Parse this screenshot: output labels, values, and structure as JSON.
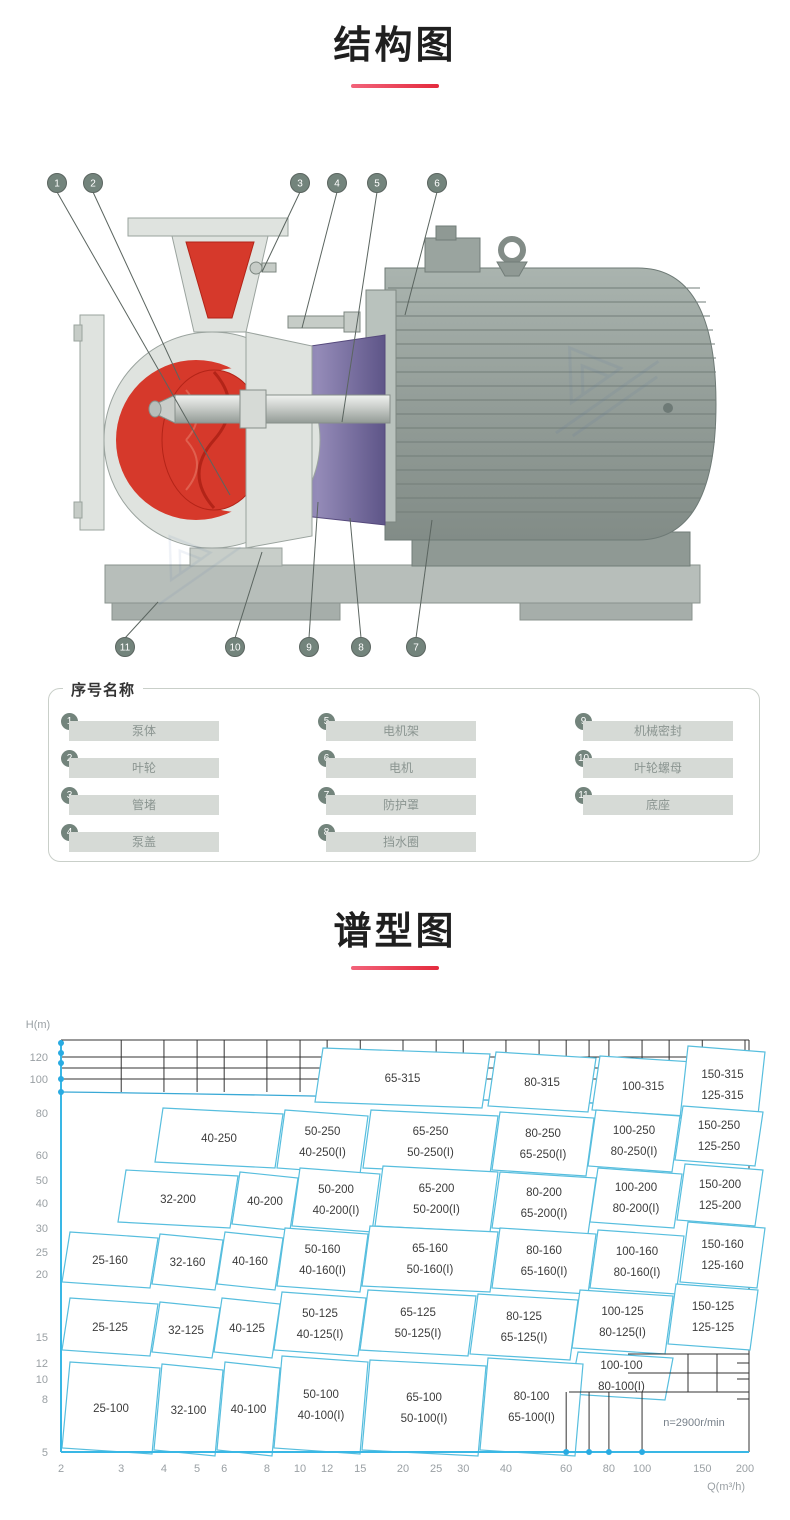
{
  "accent_color": "#e42a3d",
  "sections": {
    "structure": {
      "title": "结构图"
    },
    "spectrum": {
      "title": "谱型图"
    }
  },
  "legend": {
    "title": "序号名称",
    "items": [
      {
        "no": "1",
        "name": "泵体"
      },
      {
        "no": "2",
        "name": "叶轮"
      },
      {
        "no": "3",
        "name": "管堵"
      },
      {
        "no": "4",
        "name": "泵盖"
      },
      {
        "no": "5",
        "name": "电机架"
      },
      {
        "no": "6",
        "name": "电机"
      },
      {
        "no": "7",
        "name": "防护罩"
      },
      {
        "no": "8",
        "name": "挡水圈"
      },
      {
        "no": "9",
        "name": "机械密封"
      },
      {
        "no": "10",
        "name": "叶轮螺母"
      },
      {
        "no": "11",
        "name": "底座"
      }
    ]
  },
  "diagram": {
    "callouts_top": [
      "1",
      "2",
      "3",
      "4",
      "5",
      "6"
    ],
    "callouts_bottom": [
      "11",
      "10",
      "9",
      "8",
      "7"
    ],
    "colors": {
      "casing": "#dfe3df",
      "impeller_red": "#d6392b",
      "bracket_purple": "#837aab",
      "motor_gray": "#99a39e",
      "base_gray": "#b7beba",
      "callout": "#73847c"
    }
  },
  "chart_data": {
    "type": "area",
    "subtype": "pump-selection-map",
    "title": "谱型图",
    "xlabel": "Q(m³/h)",
    "ylabel": "H(m)",
    "x_scale": "log",
    "x_range": [
      2,
      200
    ],
    "y_range": [
      5,
      150
    ],
    "x_ticks": [
      2,
      3,
      4,
      5,
      6,
      8,
      10,
      12,
      15,
      20,
      25,
      30,
      40,
      60,
      80,
      100,
      150,
      200
    ],
    "y_ticks": [
      120,
      100,
      80,
      60,
      50,
      40,
      30,
      25,
      20,
      15,
      12,
      10,
      8,
      5
    ],
    "annotation": "n=2900r/min",
    "legend_position": "bottom-right",
    "grid": true,
    "tiles": [
      {
        "labels": [
          "65-315"
        ],
        "box": [
          315,
          38,
          482,
          92
        ]
      },
      {
        "labels": [
          "80-315"
        ],
        "box": [
          488,
          42,
          588,
          96
        ]
      },
      {
        "labels": [
          "100-315"
        ],
        "box": [
          592,
          46,
          686,
          100
        ]
      },
      {
        "labels": [
          "150-315",
          "125-315"
        ],
        "box": [
          680,
          36,
          757,
          108
        ]
      },
      {
        "labels": [
          "40-250"
        ],
        "box": [
          155,
          98,
          275,
          152
        ]
      },
      {
        "labels": [
          "50-250",
          "40-250(I)"
        ],
        "box": [
          277,
          100,
          360,
          158
        ]
      },
      {
        "labels": [
          "65-250",
          "50-250(I)"
        ],
        "box": [
          363,
          100,
          490,
          158
        ]
      },
      {
        "labels": [
          "80-250",
          "65-250(I)"
        ],
        "box": [
          492,
          102,
          586,
          160
        ]
      },
      {
        "labels": [
          "100-250",
          "80-250(I)"
        ],
        "box": [
          588,
          100,
          672,
          156
        ]
      },
      {
        "labels": [
          "150-250",
          "125-250"
        ],
        "box": [
          675,
          96,
          755,
          150
        ]
      },
      {
        "labels": [
          "32-200"
        ],
        "box": [
          118,
          160,
          230,
          212
        ]
      },
      {
        "labels": [
          "40-200"
        ],
        "box": [
          232,
          162,
          290,
          214
        ]
      },
      {
        "labels": [
          "50-200",
          "40-200(I)"
        ],
        "box": [
          292,
          158,
          372,
          216
        ]
      },
      {
        "labels": [
          "65-200",
          "50-200(I)"
        ],
        "box": [
          375,
          156,
          490,
          216
        ]
      },
      {
        "labels": [
          "80-200",
          "65-200(I)"
        ],
        "box": [
          492,
          162,
          588,
          218
        ]
      },
      {
        "labels": [
          "100-200",
          "80-200(I)"
        ],
        "box": [
          590,
          158,
          674,
          212
        ]
      },
      {
        "labels": [
          "150-200",
          "125-200"
        ],
        "box": [
          677,
          154,
          755,
          210
        ]
      },
      {
        "labels": [
          "25-160"
        ],
        "box": [
          62,
          222,
          150,
          272
        ]
      },
      {
        "labels": [
          "32-160"
        ],
        "box": [
          152,
          224,
          215,
          274
        ]
      },
      {
        "labels": [
          "40-160"
        ],
        "box": [
          217,
          222,
          275,
          274
        ]
      },
      {
        "labels": [
          "50-160",
          "40-160(I)"
        ],
        "box": [
          277,
          218,
          360,
          276
        ]
      },
      {
        "labels": [
          "65-160",
          "50-160(I)"
        ],
        "box": [
          362,
          216,
          490,
          276
        ]
      },
      {
        "labels": [
          "80-160",
          "65-160(I)"
        ],
        "box": [
          492,
          218,
          588,
          278
        ]
      },
      {
        "labels": [
          "100-160",
          "80-160(I)"
        ],
        "box": [
          590,
          220,
          676,
          278
        ]
      },
      {
        "labels": [
          "150-160",
          "125-160"
        ],
        "box": [
          680,
          212,
          757,
          272
        ]
      },
      {
        "labels": [
          "25-125"
        ],
        "box": [
          62,
          288,
          150,
          340
        ]
      },
      {
        "labels": [
          "32-125"
        ],
        "box": [
          152,
          292,
          212,
          342
        ]
      },
      {
        "labels": [
          "40-125"
        ],
        "box": [
          214,
          288,
          272,
          342
        ]
      },
      {
        "labels": [
          "50-125",
          "40-125(I)"
        ],
        "box": [
          274,
          282,
          358,
          340
        ]
      },
      {
        "labels": [
          "65-125",
          "50-125(I)"
        ],
        "box": [
          360,
          280,
          468,
          340
        ]
      },
      {
        "labels": [
          "80-125",
          "65-125(I)"
        ],
        "box": [
          470,
          284,
          570,
          344
        ]
      },
      {
        "labels": [
          "100-125",
          "80-125(I)"
        ],
        "box": [
          572,
          280,
          665,
          338
        ]
      },
      {
        "labels": [
          "150-125",
          "125-125"
        ],
        "box": [
          668,
          274,
          750,
          334
        ]
      },
      {
        "labels": [
          "100-100",
          "80-100(I)"
        ],
        "box": [
          570,
          342,
          665,
          384
        ]
      },
      {
        "labels": [
          "25-100"
        ],
        "box": [
          62,
          352,
          152,
          438
        ]
      },
      {
        "labels": [
          "32-100"
        ],
        "box": [
          154,
          354,
          215,
          440
        ]
      },
      {
        "labels": [
          "40-100"
        ],
        "box": [
          217,
          352,
          272,
          440
        ]
      },
      {
        "labels": [
          "50-100",
          "40-100(I)"
        ],
        "box": [
          274,
          346,
          360,
          438
        ]
      },
      {
        "labels": [
          "65-100",
          "50-100(I)"
        ],
        "box": [
          362,
          350,
          478,
          440
        ]
      },
      {
        "labels": [
          "80-100",
          "65-100(I)"
        ],
        "box": [
          480,
          348,
          575,
          440
        ]
      }
    ]
  }
}
